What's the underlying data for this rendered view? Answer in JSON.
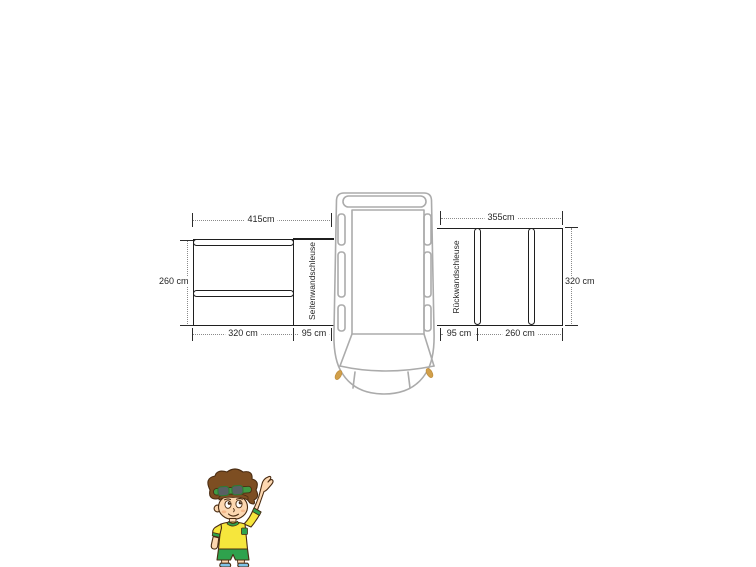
{
  "diagram": {
    "left_annex": {
      "label": "Seitenwandschleuse",
      "top_width": "415cm",
      "side_height": "260 cm",
      "bottom_width_main": "320 cm",
      "bottom_width_tunnel": "95 cm"
    },
    "right_annex": {
      "label": "Rückwandschleuse",
      "top_width": "355cm",
      "side_height": "320 cm",
      "bottom_width_tunnel": "95 cm",
      "bottom_width_main": "260 cm"
    },
    "vehicle_illustration": "van-top-view",
    "mascot_illustration": "cartoon-boy-waving"
  },
  "colors": {
    "structure_line": "#1f1f1f",
    "dimension_dots": "#8a8a8a",
    "van_outline": "#ababab",
    "headlight": "#d2a04a",
    "boy_hair": "#7d4e22",
    "boy_skin": "#fcd7b0",
    "boy_shirt": "#f6e63c",
    "boy_green": "#2fa24d",
    "boy_shoes": "#7ec3e8"
  }
}
